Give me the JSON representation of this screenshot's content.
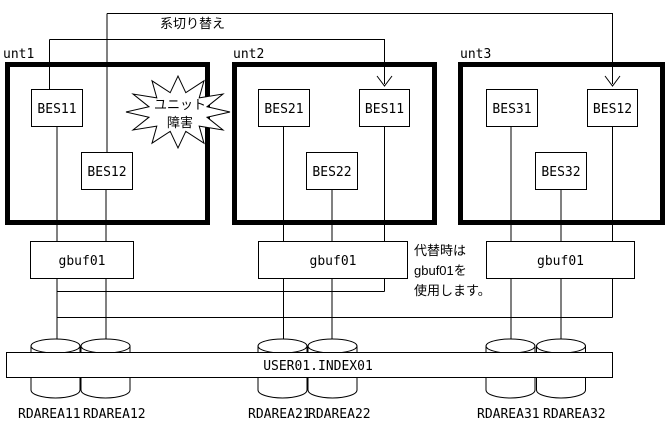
{
  "switchover_label": "系切り替え",
  "units": [
    {
      "label": "unt1",
      "bes1": "BES11",
      "bes2": "BES12"
    },
    {
      "label": "unt2",
      "bes1": "BES21",
      "bes2": "BES22",
      "bes_failover": "BES11"
    },
    {
      "label": "unt3",
      "bes1": "BES31",
      "bes2": "BES32",
      "bes_failover": "BES12"
    }
  ],
  "failure_burst": {
    "line1": "ユニット",
    "line2": "障害"
  },
  "gbuf": {
    "unit1": "gbuf01",
    "unit2": "gbuf01",
    "unit3": "gbuf01"
  },
  "note": {
    "line1": "代替時は",
    "line2": "gbuf01を",
    "line3": "使用します。"
  },
  "index_table": "USER01.INDEX01",
  "rdareas": [
    "RDAREA11",
    "RDAREA12",
    "RDAREA21",
    "RDAREA22",
    "RDAREA31",
    "RDAREA32"
  ],
  "colors": {
    "line": "#000000",
    "background": "#ffffff"
  }
}
